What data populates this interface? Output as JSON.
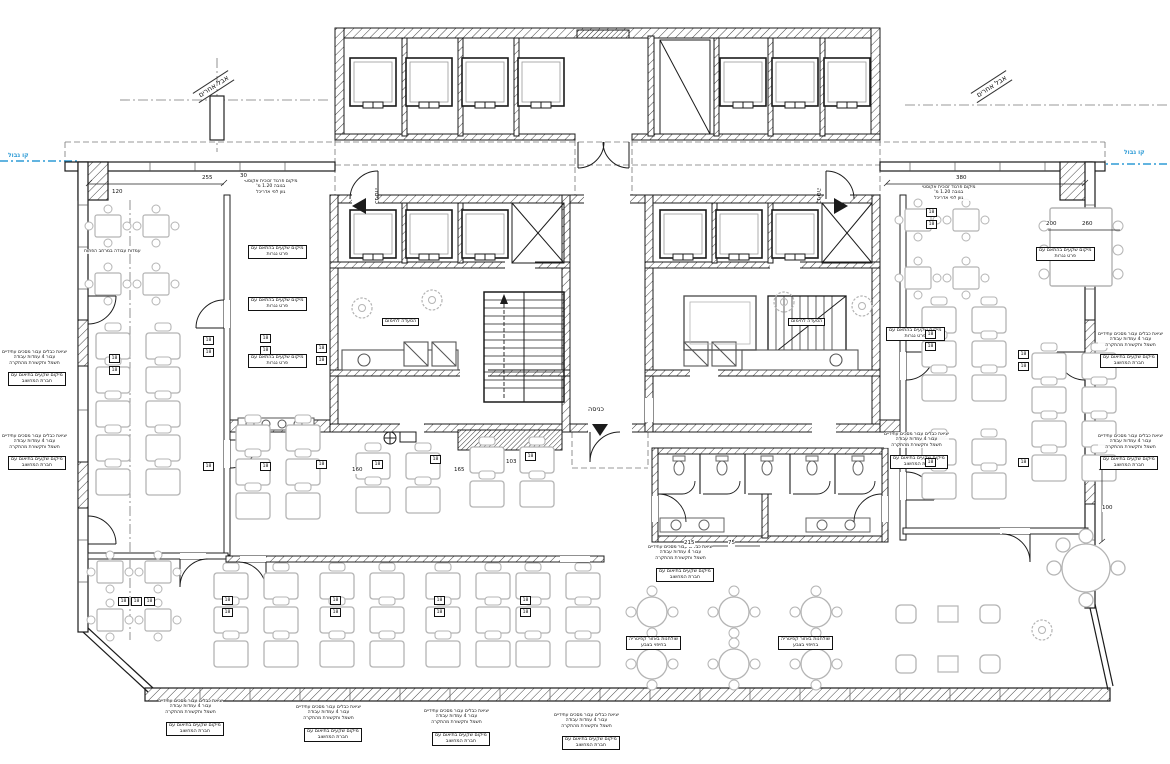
{
  "colors": {
    "boundary_blue": "#2e9bd6",
    "line": "#1b1b1b",
    "furniture_gray": "#b4b4b4"
  },
  "symbols": {
    "floor_box_label": "18"
  },
  "annotations": [
    {
      "name": "boundary-label-left",
      "cls": "blue",
      "x": 8,
      "y": 152,
      "lines": [
        "קו גבול"
      ]
    },
    {
      "name": "boundary-label-right",
      "cls": "blue",
      "x": 1124,
      "y": 149,
      "lines": [
        "קו גבול"
      ]
    },
    {
      "name": "tenant-area-label-left",
      "cls": "rot",
      "x": 196,
      "y": 92,
      "rot": -33,
      "lines": [
        "אבל אחרים"
      ]
    },
    {
      "name": "tenant-area-label-right",
      "cls": "rot",
      "x": 974,
      "y": 92,
      "rot": -33,
      "lines": [
        "אבל אחרים"
      ]
    },
    {
      "name": "entrance-label-west",
      "cls": "vert",
      "x": 372,
      "y": 188,
      "lines": [
        "כניסה"
      ]
    },
    {
      "name": "entrance-label-east",
      "cls": "vert",
      "x": 814,
      "y": 188,
      "lines": [
        "כניסה"
      ]
    },
    {
      "name": "entrance-label-south",
      "cls": "ent",
      "x": 588,
      "y": 406,
      "lines": [
        "כניסה"
      ]
    },
    {
      "name": "pantry-label-west",
      "cls": "boxed",
      "x": 382,
      "y": 318,
      "lines": [
        "הסעדה לחימום"
      ]
    },
    {
      "name": "pantry-label-east",
      "cls": "boxed",
      "x": 788,
      "y": 318,
      "lines": [
        "הסעדה לחימום"
      ]
    },
    {
      "name": "acoustic-partition-note-west",
      "cls": "note",
      "x": 244,
      "y": 179,
      "lines": [
        "מיקום פרגוד זכוכית אקוסטי",
        "בגובה 1.20 מ'",
        "גוון לפי אדריכל"
      ]
    },
    {
      "name": "acoustic-partition-note-east",
      "cls": "note",
      "x": 922,
      "y": 185,
      "lines": [
        "מיקום פרגוד זכוכית אקוסטי",
        "בגובה 1.20 מ'",
        "גוון לפי אדריכל"
      ]
    },
    {
      "name": "cable-exit-note-left-1",
      "cls": "note",
      "x": 2,
      "y": 350,
      "lines": [
        "יציאת כבלים עבור מסכים עתידיים",
        "עבור 4 עמדות עבודה",
        "חשמל ותקשורת מהתקרה"
      ]
    },
    {
      "name": "outlet-box-left-1",
      "cls": "boxed",
      "x": 8,
      "y": 372,
      "lines": [
        "מיקום שקעים בתיאום עם",
        "חברת המחשוב"
      ]
    },
    {
      "name": "cable-exit-note-left-2",
      "cls": "note",
      "x": 2,
      "y": 434,
      "lines": [
        "יציאת כבלים עבור מסכים עתידיים",
        "עבור 4 עמדות עבודה",
        "חשמל ותקשורת מהתקרה"
      ]
    },
    {
      "name": "outlet-box-left-2",
      "cls": "boxed",
      "x": 8,
      "y": 456,
      "lines": [
        "מיקום שקעים בתיאום עם",
        "חברת המחשוב"
      ]
    },
    {
      "name": "cable-exit-note-right-1",
      "cls": "note",
      "x": 1098,
      "y": 332,
      "lines": [
        "יציאת כבלים עבור מסכים עתידיים",
        "עבור 4 עמדות עבודה",
        "חשמל ותקשורת מהתקרה"
      ]
    },
    {
      "name": "outlet-box-right-1",
      "cls": "boxed",
      "x": 1100,
      "y": 354,
      "lines": [
        "מיקום שקעים בתיאום עם",
        "חברת המחשוב"
      ]
    },
    {
      "name": "cable-exit-note-right-2",
      "cls": "note",
      "x": 1098,
      "y": 434,
      "lines": [
        "יציאת כבלים עבור מסכים עתידיים",
        "עבור 4 עמדות עבודה",
        "חשמל ותקשורת מהתקרה"
      ]
    },
    {
      "name": "outlet-box-right-2",
      "cls": "boxed",
      "x": 1100,
      "y": 456,
      "lines": [
        "מיקום שקעים בתיאום עם",
        "חברת המחשוב"
      ]
    },
    {
      "name": "cable-exit-note-bottom-1",
      "cls": "note",
      "x": 158,
      "y": 699,
      "lines": [
        "יציאת כבלים עבור מסכים עתידיים",
        "עבור 4 עמדות עבודה",
        "חשמל ותקשורת מהתקרה"
      ]
    },
    {
      "name": "outlet-box-bottom-1",
      "cls": "boxed",
      "x": 166,
      "y": 722,
      "lines": [
        "מיקום שקעים בתיאום עם",
        "חברת המחשוב"
      ]
    },
    {
      "name": "cable-exit-note-bottom-2",
      "cls": "note",
      "x": 296,
      "y": 705,
      "lines": [
        "יציאת כבלים עבור מסכים עתידיים",
        "עבור 4 עמדות עבודה",
        "חשמל ותקשורת מהתקרה"
      ]
    },
    {
      "name": "outlet-box-bottom-2",
      "cls": "boxed",
      "x": 304,
      "y": 728,
      "lines": [
        "מיקום שקעים בתיאום עם",
        "חברת המחשוב"
      ]
    },
    {
      "name": "cable-exit-note-bottom-3",
      "cls": "note",
      "x": 424,
      "y": 709,
      "lines": [
        "יציאת כבלים עבור מסכים עתידיים",
        "עבור 4 עמדות עבודה",
        "חשמל ותקשורת מהתקרה"
      ]
    },
    {
      "name": "outlet-box-bottom-3",
      "cls": "boxed",
      "x": 432,
      "y": 732,
      "lines": [
        "מיקום שקעים בתיאום עם",
        "חברת המחשוב"
      ]
    },
    {
      "name": "cable-exit-note-bottom-4",
      "cls": "note",
      "x": 554,
      "y": 713,
      "lines": [
        "יציאת כבלים עבור מסכים עתידיים",
        "עבור 4 עמדות עבודה",
        "חשמל ותקשורת מהתקרה"
      ]
    },
    {
      "name": "outlet-box-bottom-4",
      "cls": "boxed",
      "x": 562,
      "y": 736,
      "lines": [
        "מיקום שקעים בתיאום עם",
        "חברת המחשוב"
      ]
    },
    {
      "name": "cable-exit-note-center-south",
      "cls": "note",
      "x": 648,
      "y": 545,
      "lines": [
        "יציאת כבלים עבור מסכים עתידיים",
        "עבור 4 עמדות עבודה",
        "חשמל ותקשורת מהתקרה"
      ]
    },
    {
      "name": "outlet-box-center-south",
      "cls": "boxed",
      "x": 656,
      "y": 568,
      "lines": [
        "מיקום שקעים בתיאום עם",
        "חברת המחשוב"
      ]
    },
    {
      "name": "carpentry-outlet-box-1",
      "cls": "boxed",
      "x": 248,
      "y": 245,
      "lines": [
        "מיקום שקעים בהתאם עם",
        "פרט נגרות"
      ]
    },
    {
      "name": "carpentry-outlet-box-2",
      "cls": "boxed",
      "x": 248,
      "y": 297,
      "lines": [
        "מיקום שקעים בהתאם עם",
        "פרט נגרות"
      ]
    },
    {
      "name": "carpentry-outlet-box-3",
      "cls": "boxed",
      "x": 248,
      "y": 354,
      "lines": [
        "מיקום שקעים בהתאם עם",
        "פרט נגרות"
      ]
    },
    {
      "name": "carpentry-outlet-box-4",
      "cls": "boxed",
      "x": 886,
      "y": 327,
      "lines": [
        "מיקום שקעים בהתאם עם",
        "פרט נגרות"
      ]
    },
    {
      "name": "carpentry-outlet-box-5",
      "cls": "boxed",
      "x": 1036,
      "y": 247,
      "lines": [
        "מיקום שקעים בהתאם עם",
        "פרט נגרות"
      ]
    },
    {
      "name": "cable-exit-note-right-inner",
      "cls": "note",
      "x": 884,
      "y": 432,
      "lines": [
        "יציאת כבלים עבור מסכים עתידיים",
        "עבור 4 עמדות עבודה",
        "חשמל ותקשורת מהתקרה"
      ]
    },
    {
      "name": "outlet-box-right-inner",
      "cls": "boxed",
      "x": 890,
      "y": 455,
      "lines": [
        "מיקום שקעים בתיאום עם",
        "חברת המחשוב"
      ]
    },
    {
      "name": "cafeteria-table-box-1",
      "cls": "boxed",
      "x": 626,
      "y": 636,
      "lines": [
        "שולחנות באזור קפיטריה",
        "בחיפוי בצבע"
      ]
    },
    {
      "name": "cafeteria-table-box-2",
      "cls": "boxed",
      "x": 778,
      "y": 636,
      "lines": [
        "שולחנות באזור קפיטריה",
        "בחיפוי בצבע"
      ]
    },
    {
      "name": "open-space-note",
      "cls": "note",
      "x": 84,
      "y": 249,
      "lines": [
        "עמדות עבודה במרחב הפתוח"
      ]
    },
    {
      "name": "dim-255",
      "cls": "dim",
      "x": 202,
      "y": 175,
      "lines": [
        "255"
      ]
    },
    {
      "name": "dim-30",
      "cls": "dim",
      "x": 240,
      "y": 173,
      "lines": [
        "30"
      ]
    },
    {
      "name": "dim-380",
      "cls": "dim",
      "x": 956,
      "y": 175,
      "lines": [
        "380"
      ]
    },
    {
      "name": "dim-120",
      "cls": "dim",
      "x": 112,
      "y": 189,
      "lines": [
        "120"
      ]
    },
    {
      "name": "dim-200",
      "cls": "dim",
      "x": 1046,
      "y": 221,
      "lines": [
        "200"
      ]
    },
    {
      "name": "dim-260",
      "cls": "dim",
      "x": 1082,
      "y": 221,
      "lines": [
        "260"
      ]
    },
    {
      "name": "dim-160",
      "cls": "dim",
      "x": 352,
      "y": 467,
      "lines": [
        "160"
      ]
    },
    {
      "name": "dim-165",
      "cls": "dim",
      "x": 454,
      "y": 467,
      "lines": [
        "165"
      ]
    },
    {
      "name": "dim-103",
      "cls": "dim",
      "x": 506,
      "y": 459,
      "lines": [
        "103"
      ]
    },
    {
      "name": "dim-100",
      "cls": "dim",
      "x": 1102,
      "y": 505,
      "lines": [
        "100"
      ]
    },
    {
      "name": "dim-215",
      "cls": "dim",
      "x": 684,
      "y": 540,
      "lines": [
        "215"
      ]
    },
    {
      "name": "dim-75",
      "cls": "dim",
      "x": 728,
      "y": 540,
      "lines": [
        "75"
      ]
    }
  ],
  "floor_boxes": [
    [
      109,
      354
    ],
    [
      109,
      366
    ],
    [
      203,
      336
    ],
    [
      203,
      348
    ],
    [
      260,
      334
    ],
    [
      260,
      346
    ],
    [
      316,
      344
    ],
    [
      316,
      356
    ],
    [
      203,
      462
    ],
    [
      260,
      462
    ],
    [
      316,
      460
    ],
    [
      372,
      460
    ],
    [
      430,
      455
    ],
    [
      525,
      452
    ],
    [
      925,
      330
    ],
    [
      925,
      342
    ],
    [
      1018,
      350
    ],
    [
      1018,
      362
    ],
    [
      925,
      458
    ],
    [
      1018,
      458
    ],
    [
      118,
      597
    ],
    [
      131,
      597
    ],
    [
      144,
      597
    ],
    [
      222,
      596
    ],
    [
      222,
      608
    ],
    [
      330,
      596
    ],
    [
      330,
      608
    ],
    [
      434,
      596
    ],
    [
      434,
      608
    ],
    [
      520,
      596
    ],
    [
      520,
      608
    ],
    [
      926,
      208
    ],
    [
      926,
      220
    ]
  ]
}
